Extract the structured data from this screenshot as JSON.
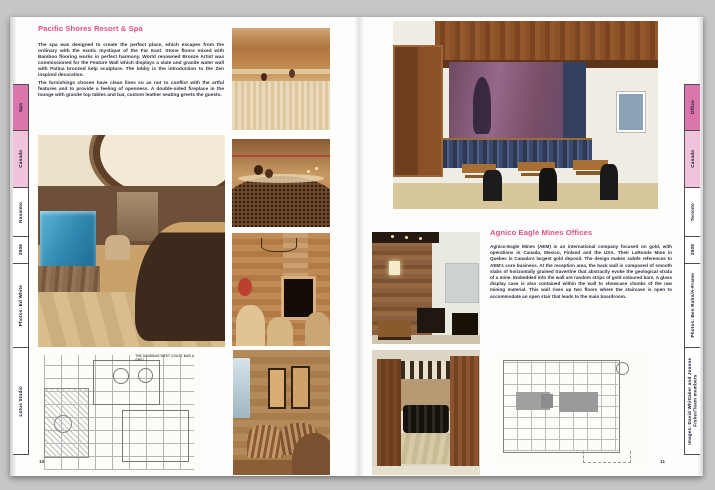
{
  "spread": {
    "left_page": {
      "page_number": "10",
      "title": "Pacific Shores Resort & Spa",
      "paragraph1": "The spa was designed to create the perfect place, which escapes from the ordinary with the exotic mystique of the Far East. Stone floors mixed with Bamboo flooring works in perfect harmony. World renowned Bronze Artist was commissioned for the Feature Wall which displays a slate and granite water wall with Patina bronzed kelp sculpture. The lobby is the introduction to the Zen inspired decoration.",
      "paragraph2": "The furnishings chosen have clean lines so as not to conflict with the artful features and to provide a feeling of openness. A double-sided fireplace in the lounge with granite top tables and bar, custom leather seating greets the guests.",
      "floorplan_label": "THE SANDBAR WEST COAST BAR & GRILL",
      "tabs": [
        {
          "label": "Spa"
        },
        {
          "label": "Canada"
        },
        {
          "label": "Nanaimo"
        },
        {
          "label": "2006"
        },
        {
          "label": "Photos: Ed White"
        },
        {
          "label": "Lotus Studio"
        }
      ]
    },
    "right_page": {
      "page_number": "11",
      "title": "Agnico Eagle Mines Offices",
      "paragraph1": "Agnico-Eagle Mines (AEM) is an international company focused on gold, with operations in Canada, Mexico, Finland and the USA. Their LaRonde Mine in Quebec is Canada's largest gold deposit. The design makes subtle references to AEM's core business. At the reception area, the back wall is composed of smooth slabs of horizontally grained travertine that abstractly evoke the geological strata of a mine. Embedded into the wall are random strips of gold coloured bars. A glass display case is also contained within the wall to showcase chunks of the raw mining material. This wall rises up two floors where the staircase is open to accommodate an open stair that leads to the main boardroom.",
      "tabs": [
        {
          "label": "Office"
        },
        {
          "label": "Canada"
        },
        {
          "label": "Toronto"
        },
        {
          "label": "2008"
        },
        {
          "label": "Photos: Ben Rahn/A-Frame"
        },
        {
          "label": "Images: David Whittaker and Joanne Fisher/Team members"
        }
      ]
    },
    "colors": {
      "accent_pink": "#e54e87",
      "tab_pink": "#db76ad",
      "tab_light_pink": "#f1c3da",
      "body_text": "#2f3044"
    }
  }
}
